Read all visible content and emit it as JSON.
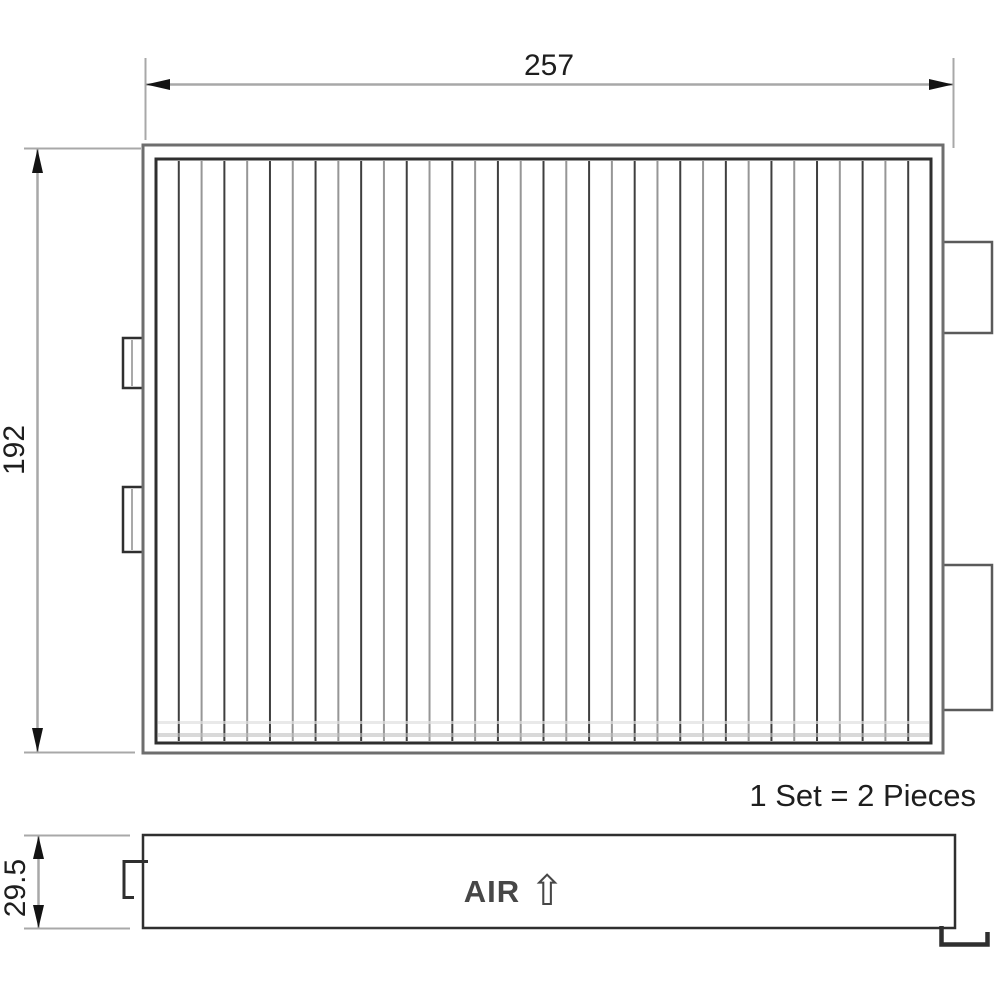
{
  "drawing": {
    "dim_width": "257",
    "dim_height": "192",
    "dim_depth": "29.5",
    "set_note": "1 Set = 2 Pieces",
    "air_label": "AIR",
    "air_arrow": "⇧",
    "pleats": {
      "count": 33,
      "dark": "#3f3f3f",
      "light": "#969696"
    },
    "colors": {
      "line_dark": "#2f2f2f",
      "line_mid": "#5a5a5a",
      "line_frame": "#6e6e6e",
      "line_grey": "#8c8c8c",
      "dim_line": "#a8a8a8",
      "arrow": "#131313",
      "text": "#1e1e1e"
    }
  }
}
